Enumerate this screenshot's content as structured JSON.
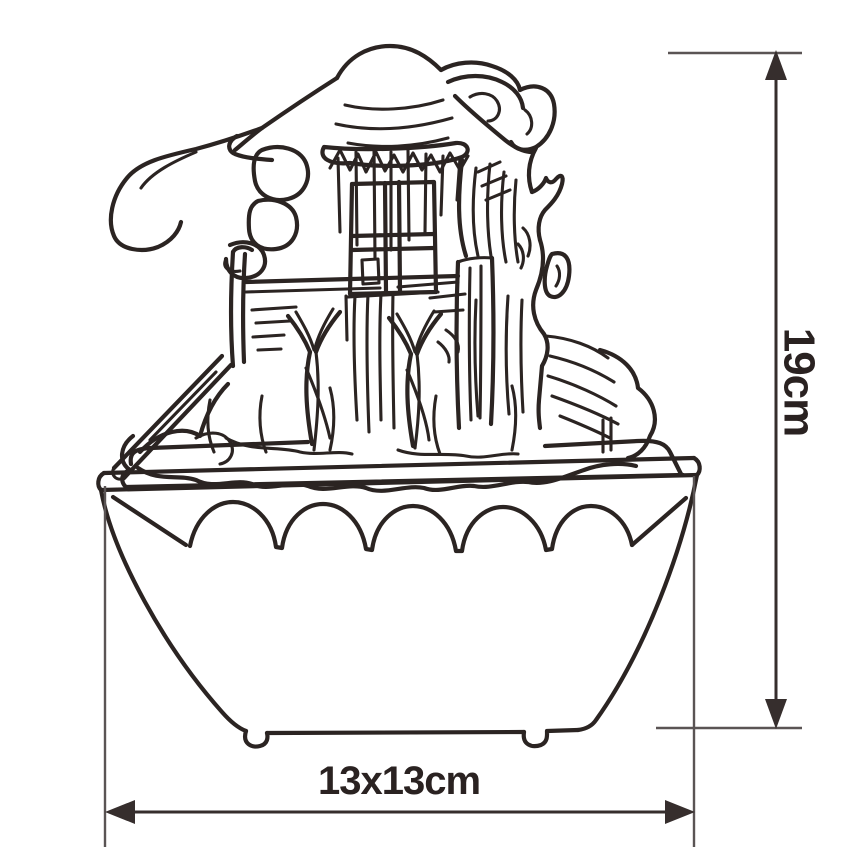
{
  "page": {
    "background": "#ffffff"
  },
  "illustration": {
    "subject": "hand-drawn tabletop cottage water fountain",
    "line_color": "#2b2422",
    "parts": [
      "thatched-roof",
      "roof-fringe",
      "stone-stack",
      "window-with-cross-frame",
      "water-trough",
      "branch-supports",
      "waterfall-streams",
      "tree-trunk",
      "cascade-board",
      "rock-pile",
      "square-basin-scalloped-band-feet"
    ]
  },
  "dimensions": {
    "height": {
      "label": "19cm",
      "orientation": "vertical",
      "line_color": "#362e2d",
      "extension_color": "#5a5454",
      "text_color": "#2a2221"
    },
    "base": {
      "label": "13x13cm",
      "orientation": "horizontal",
      "line_color": "#362e2d",
      "extension_color": "#5a5454",
      "text_color": "#2a2221"
    }
  }
}
